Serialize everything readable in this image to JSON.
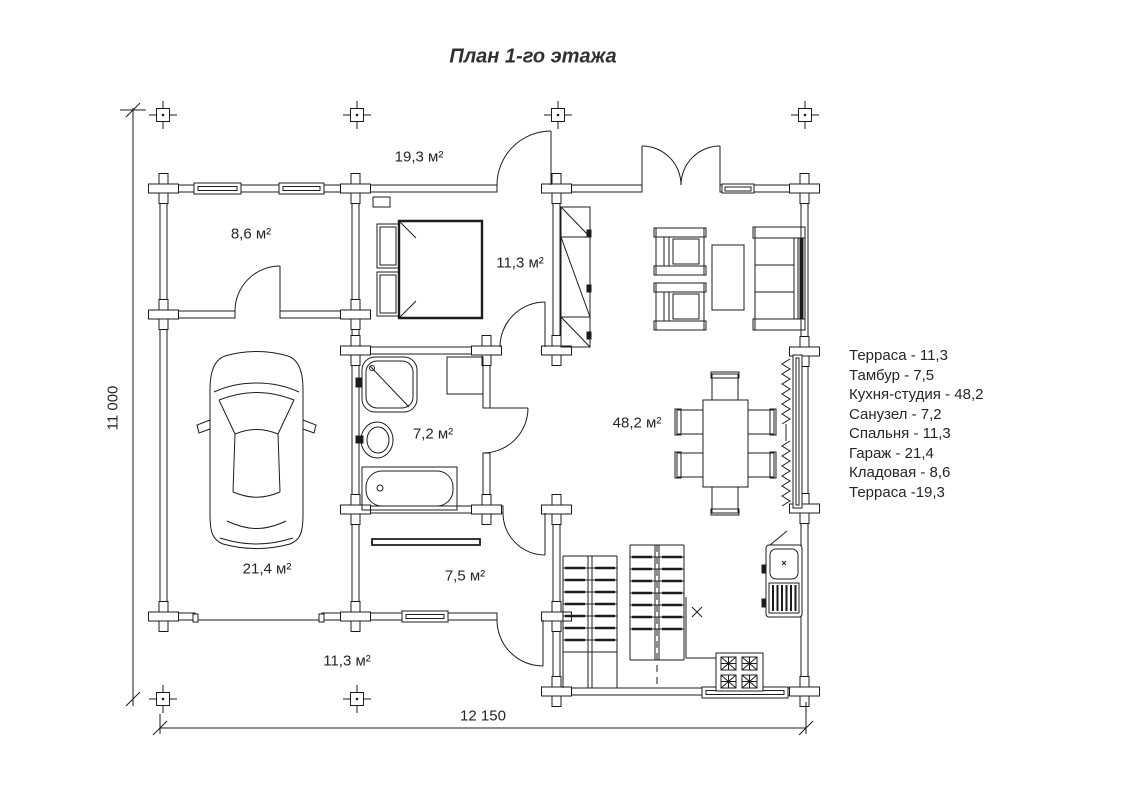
{
  "title": "План 1-го этажа",
  "dimensions": {
    "height_label": "11 000",
    "width_label": "12 150"
  },
  "room_labels": [
    {
      "id": "terrace-top",
      "label": "19,3 м²"
    },
    {
      "id": "storage",
      "label": "8,6 м²"
    },
    {
      "id": "bedroom",
      "label": "11,3 м²"
    },
    {
      "id": "bathroom",
      "label": "7,2 м²"
    },
    {
      "id": "kitchen-studio",
      "label": "48,2 м²"
    },
    {
      "id": "garage",
      "label": "21,4 м²"
    },
    {
      "id": "vestibule",
      "label": "7,5 м²"
    },
    {
      "id": "terrace-bottom",
      "label": "11,3 м²"
    }
  ],
  "legend": [
    "Терраса - 11,3",
    "Тамбур - 7,5",
    "Кухня-студия - 48,2",
    "Санузел - 7,2",
    "Спальня - 11,3",
    "Гараж - 21,4",
    "Кладовая - 8,6",
    "Терраса -19,3"
  ],
  "colors": {
    "line": "#1c1c1c",
    "text": "#262626",
    "background": "#ffffff"
  }
}
